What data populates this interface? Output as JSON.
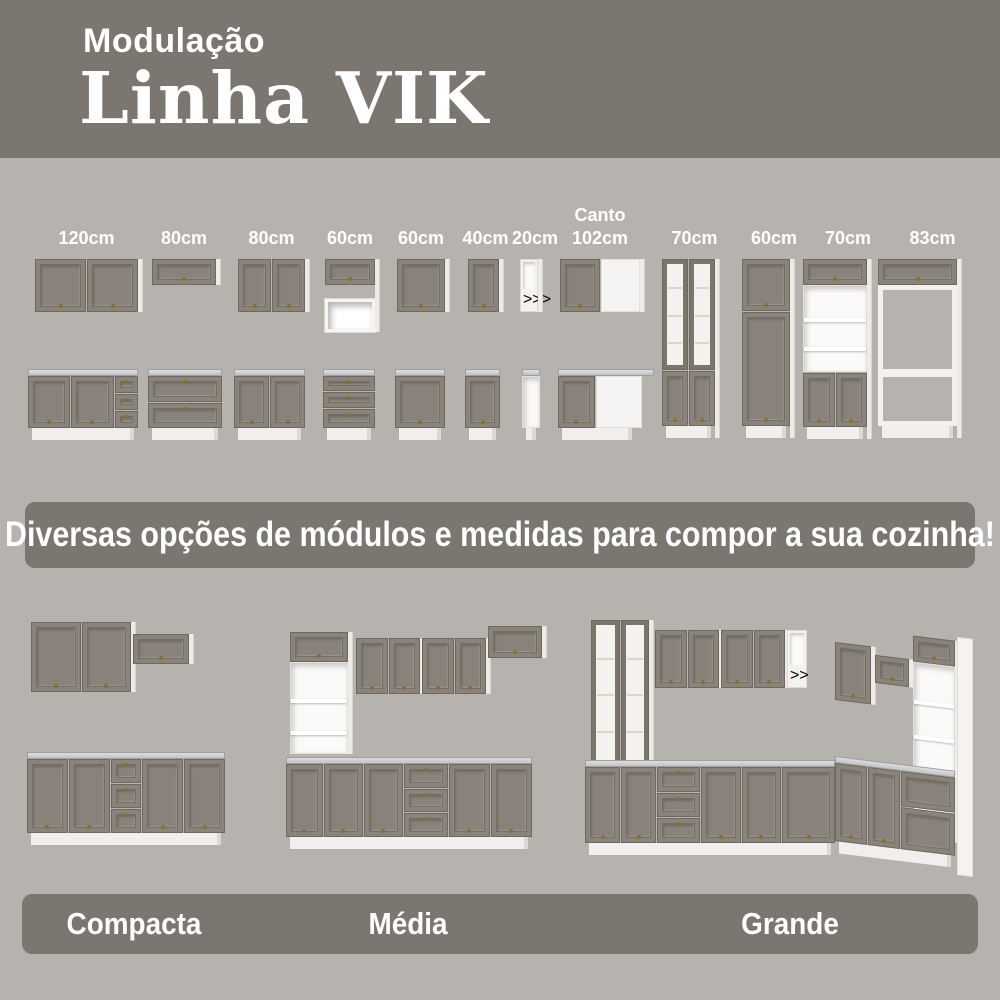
{
  "header": {
    "kicker": "Modulação",
    "title": "Linha VIK"
  },
  "modules": [
    {
      "prefix": "",
      "size": "120cm",
      "upper": "wall-two-door",
      "lower": "base-two-door-three-drawer"
    },
    {
      "prefix": "",
      "size": "80cm",
      "upper": "wall-flip-door",
      "lower": "base-two-drawer"
    },
    {
      "prefix": "",
      "size": "80cm",
      "upper": "wall-two-door",
      "lower": "base-two-door"
    },
    {
      "prefix": "",
      "size": "60cm",
      "upper": "wall-flip-door-plus-niche",
      "lower": "base-three-drawer"
    },
    {
      "prefix": "",
      "size": "60cm",
      "upper": "wall-one-door",
      "lower": "base-one-door"
    },
    {
      "prefix": "",
      "size": "40cm",
      "upper": "wall-one-door",
      "lower": "base-one-door"
    },
    {
      "prefix": "",
      "size": "20cm",
      "upper": "open-shelf-column",
      "lower": "base-open"
    },
    {
      "prefix": "Canto",
      "size": "102cm",
      "upper": "corner-wall",
      "lower": "corner-base"
    },
    {
      "prefix": "",
      "size": "70cm",
      "tall": "tall-glass-doors"
    },
    {
      "prefix": "",
      "size": "60cm",
      "tall": "tall-pantry"
    },
    {
      "prefix": "",
      "size": "70cm",
      "tall": "tall-oven-tower"
    },
    {
      "prefix": "",
      "size": "83cm",
      "tall": "tall-open-frame"
    }
  ],
  "banner": {
    "text": "Diversas opções de módulos e medidas para compor a sua cozinha!"
  },
  "kitchens": [
    {
      "name": "Compacta"
    },
    {
      "name": "Média"
    },
    {
      "name": "Grande"
    }
  ],
  "colors": {
    "page_bg": "#b6b3ae",
    "panel_bg": "#7b766f",
    "door": "#8a837a",
    "white_cabinet": "#f2f1ef",
    "countertop": "#dcdddf",
    "knob": "#8a6c35",
    "text": "#ffffff"
  }
}
